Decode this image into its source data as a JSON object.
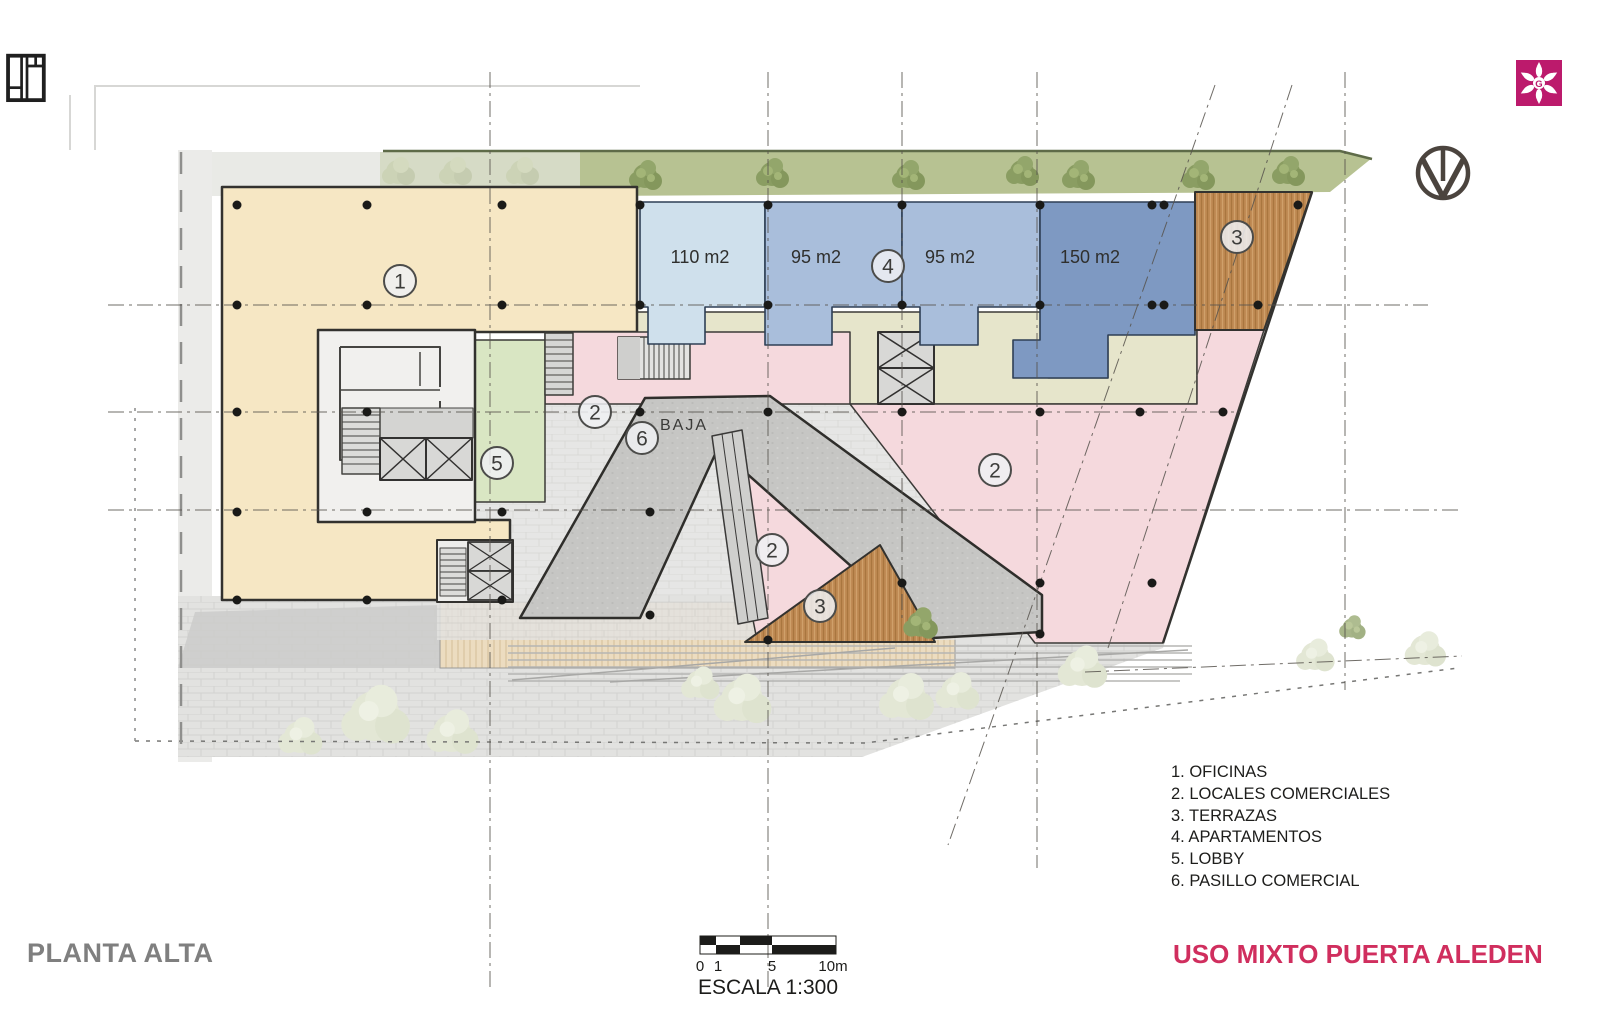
{
  "titles": {
    "sheet": "PLANTA ALTA",
    "project": "USO MIXTO PUERTA ALEDEN"
  },
  "legend": {
    "items": [
      "1. OFICINAS",
      "2. LOCALES COMERCIALES",
      "3. TERRAZAS",
      "4. APARTAMENTOS",
      "5. LOBBY",
      "6. PASILLO COMERCIAL"
    ]
  },
  "scalebar": {
    "ticks": [
      "0",
      "1",
      "5",
      "10m"
    ],
    "label": "ESCALA 1:300"
  },
  "plan": {
    "units": {
      "u110": "110 m2",
      "u95a": "95 m2",
      "u95b": "95 m2",
      "u150": "150 m2"
    },
    "baja_label": "BAJA",
    "markers": {
      "oficinas": "1",
      "locales": "2",
      "terrazas": "3",
      "apartamentos": "4",
      "lobby": "5",
      "pasillo": "6"
    }
  },
  "logo": {
    "letter": "G"
  },
  "colors": {
    "accent_pink": "#d02e5e",
    "logo_magenta": "#bc1a6c",
    "office_beige": "#f6e7c4",
    "retail_pink": "#f5d9dd",
    "lobby_green": "#d9e6c3",
    "corridor_olive": "#e6e5cb",
    "apartment_blue_light": "#cfe0ec",
    "apartment_blue": "#a9bedb",
    "apartment_blue_dark": "#7e99c2",
    "terrace_wood": "#c08b55",
    "walkway_gray": "#c6c6c4",
    "plaza_gray": "#e2e2e0",
    "landscape_green": "#b7c292"
  }
}
